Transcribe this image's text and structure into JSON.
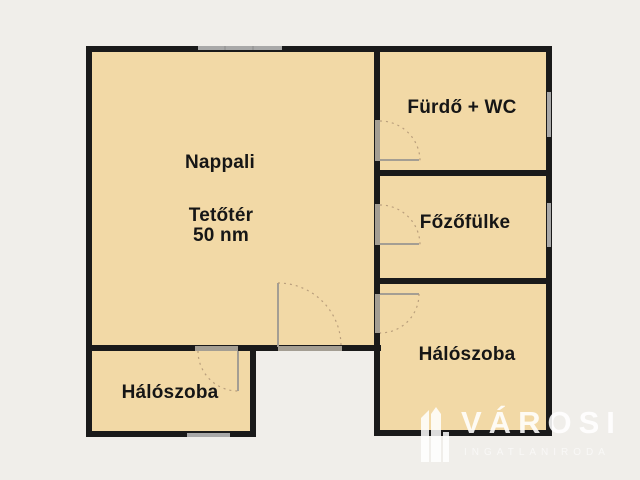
{
  "rooms": {
    "living": {
      "label": "Nappali",
      "type_label": "Tetőtér",
      "area": "50 nm"
    },
    "bathroom": {
      "label": "Fürdő + WC"
    },
    "kitchenette": {
      "label": "Főzőfülke"
    },
    "bedroom_right": {
      "label": "Hálószoba"
    },
    "bedroom_left": {
      "label": "Hálószoba"
    }
  },
  "watermark": {
    "brand": "VÁROSI",
    "tagline": "INGATLANIRODA"
  },
  "colors": {
    "background": "#f0eeea",
    "room-fill": "#f2d9a6",
    "wall": "#1a1a1a",
    "window": "#a8a8a8",
    "opening": "#a49e93",
    "arc": "#b39878",
    "label": "#161616"
  }
}
